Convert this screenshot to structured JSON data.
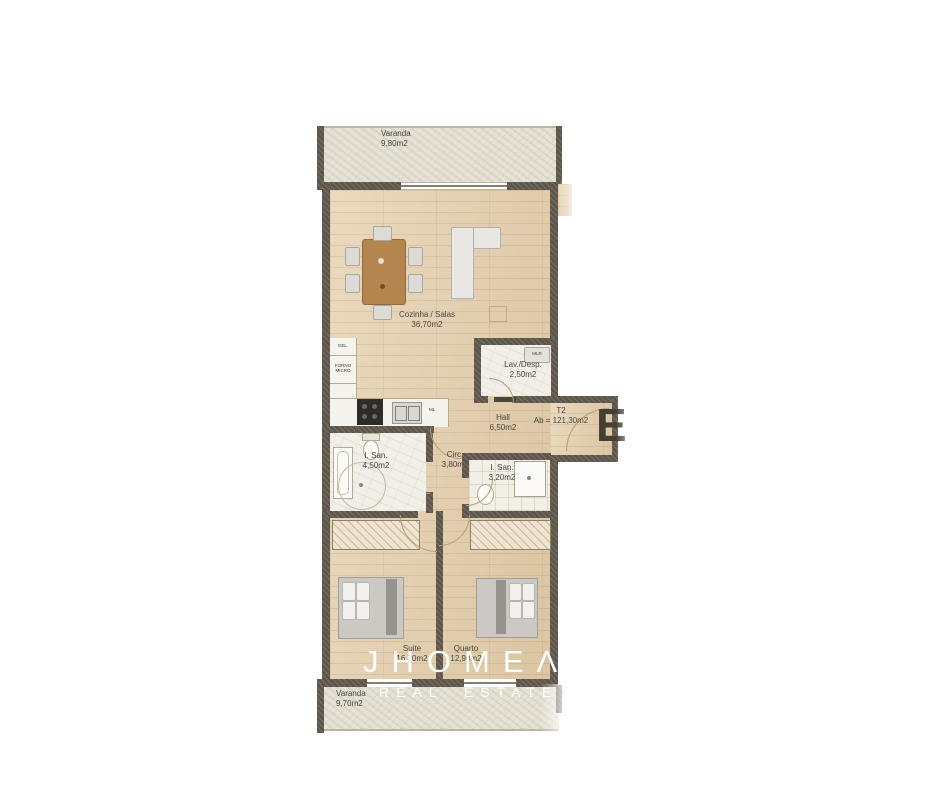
{
  "watermark": {
    "brand": "JHOMEΛ",
    "tagline": "REAL ESTATE"
  },
  "plan": {
    "entrance_letter": "E",
    "type": {
      "code": "T2",
      "area": "Ab = 121,30m2"
    },
    "rooms": {
      "varanda_top": {
        "name": "Varanda",
        "area": "9,80m2"
      },
      "cozinha_salas": {
        "name": "Cozinha / Salas",
        "area": "36,70m2"
      },
      "lav_desp": {
        "name": "Lav./Desp.",
        "area": "2,50m2"
      },
      "hall": {
        "name": "Hall",
        "area": "6,50m2"
      },
      "i_san_suite": {
        "name": "I. San.",
        "area": "4,50m2"
      },
      "circ": {
        "name": "Circ.",
        "area": "3,80m2"
      },
      "i_san": {
        "name": "I. San.",
        "area": "3,20m2"
      },
      "suite": {
        "name": "Suite",
        "area": "16,70m2"
      },
      "quarto": {
        "name": "Quarto",
        "area": "12,90m2"
      },
      "varanda_bottom": {
        "name": "Varanda",
        "area": "9,70m2"
      }
    },
    "kitchen_labels": {
      "fridge": "GEL.",
      "oven_line1": "FORNO",
      "oven_line2": "MICRO",
      "washer": "ML"
    },
    "laundry_labels": {
      "machine": "MLR"
    },
    "adjacent_fragment": "V"
  },
  "colors": {
    "wood": "#e4cda9",
    "stone": "#e6e2d6",
    "wall": "#5e564b",
    "tile": "#f2efe7",
    "table_wood": "#b5854f"
  }
}
